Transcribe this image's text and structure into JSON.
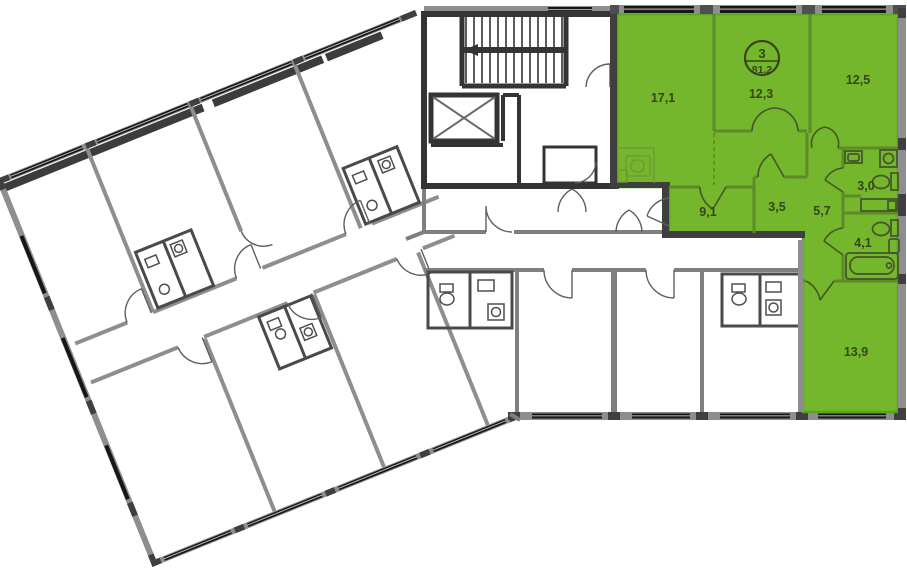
{
  "badge": {
    "rooms_count": "3",
    "total_area": "81,2"
  },
  "rooms": [
    {
      "area": "17,1"
    },
    {
      "area": "12,3"
    },
    {
      "area": "12,5"
    },
    {
      "area": "9,1"
    },
    {
      "area": "3,5"
    },
    {
      "area": "5,7"
    },
    {
      "area": "3,0"
    },
    {
      "area": "4,1"
    },
    {
      "area": "13,9"
    }
  ],
  "colors": {
    "highlight_fill": "#74b62c",
    "highlight_outline": "#58a31d",
    "wall_light": "#8e8e8e",
    "wall_dark": "#343434",
    "label_text": "#36451a"
  }
}
